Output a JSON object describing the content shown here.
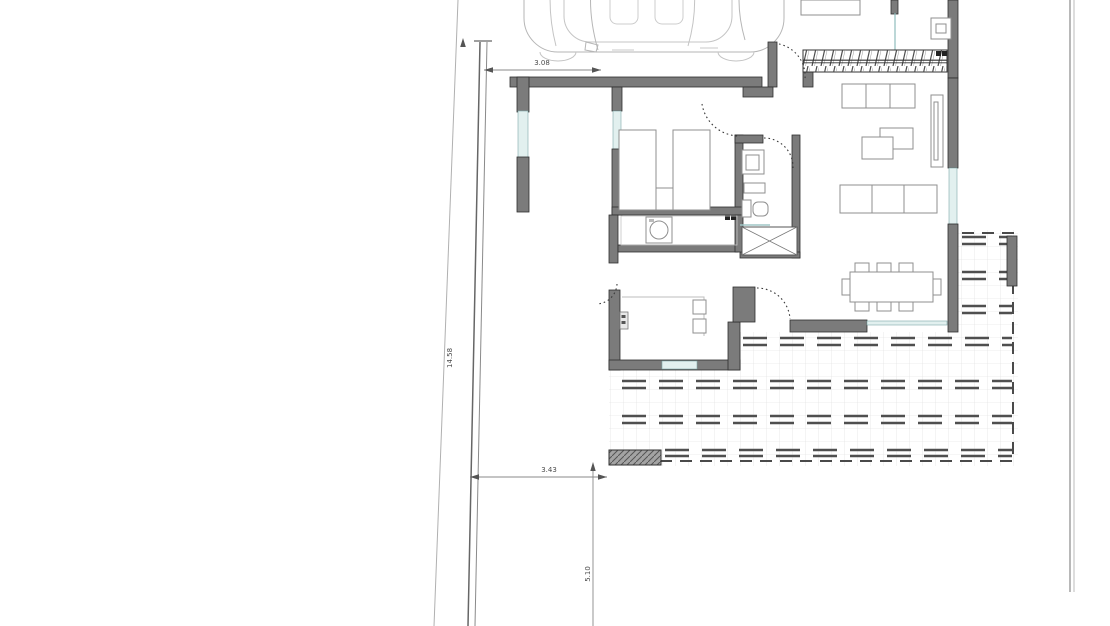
{
  "plan": {
    "dimensions": {
      "top_width": "3.08",
      "bottom_width": "3.43",
      "left_length": "14.58",
      "bottom_length": "5.10"
    },
    "colors": {
      "background": "#ffffff",
      "wall_fill": "#7b7b7b",
      "wall_outline": "#2f2f2f",
      "window_fill": "#e2f0ef",
      "furniture_stroke": "#8f8f8f",
      "terrace_dash": "#4f4f4f",
      "tile_grid": "#dcdcdc",
      "dimension_text": "#4a4a4a"
    },
    "features": [
      "car-top-view",
      "carport",
      "staircase",
      "double-bed",
      "twin-beds",
      "bathroom-sink",
      "toilet",
      "shower",
      "washing-machine",
      "kitchen-counter",
      "dining-table-8-seats",
      "sofas",
      "coffee-tables",
      "tv-sideboard",
      "terrace-decking",
      "plot-boundary",
      "door-swing-arcs"
    ]
  }
}
